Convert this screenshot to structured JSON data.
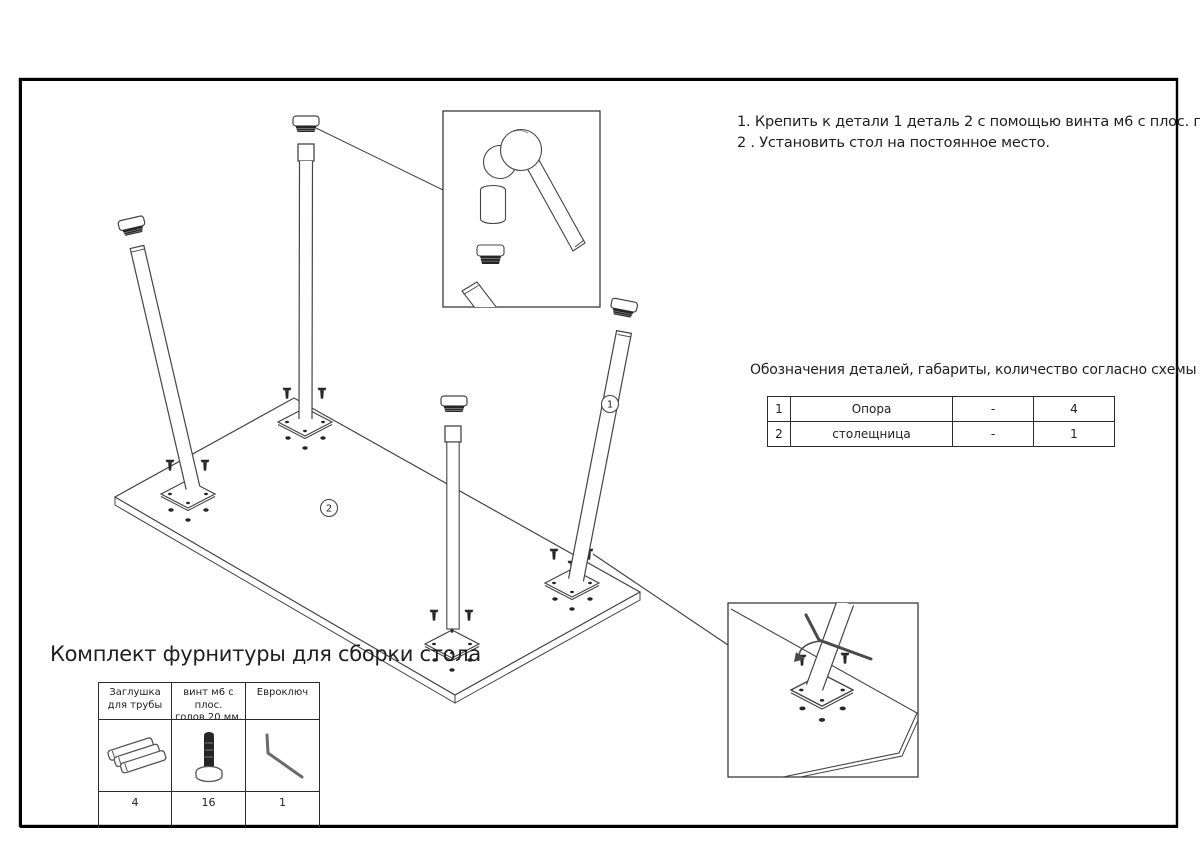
{
  "instructions": {
    "line1": "1. Крепить к детали 1 деталь 2 с помощью винта м6 с плос. голов.20 мм.",
    "line2": "2 . Установить стол на постоянное место."
  },
  "parts_table": {
    "title": "Обозначения деталей, габариты, количество согласно схемы сборки",
    "rows": [
      {
        "num": "1",
        "name": "Опора",
        "dims": "-",
        "qty": "4"
      },
      {
        "num": "2",
        "name": "столещница",
        "dims": "-",
        "qty": "1"
      }
    ]
  },
  "kit": {
    "title": "Комплект фурнитуры для сборки стола",
    "columns": [
      {
        "header": "Заглушка для трубы",
        "icon": "tube-cap-icon",
        "qty": "4"
      },
      {
        "header": "винт м6 с плос. голов.20 мм.",
        "icon": "screw-icon",
        "qty": "16"
      },
      {
        "header": "Евроключ",
        "icon": "hex-key-icon",
        "qty": "1"
      }
    ]
  },
  "diagram": {
    "labels": {
      "leg": "1",
      "tabletop": "2"
    },
    "line_color": "#444444",
    "dark_fill": "#262626"
  }
}
